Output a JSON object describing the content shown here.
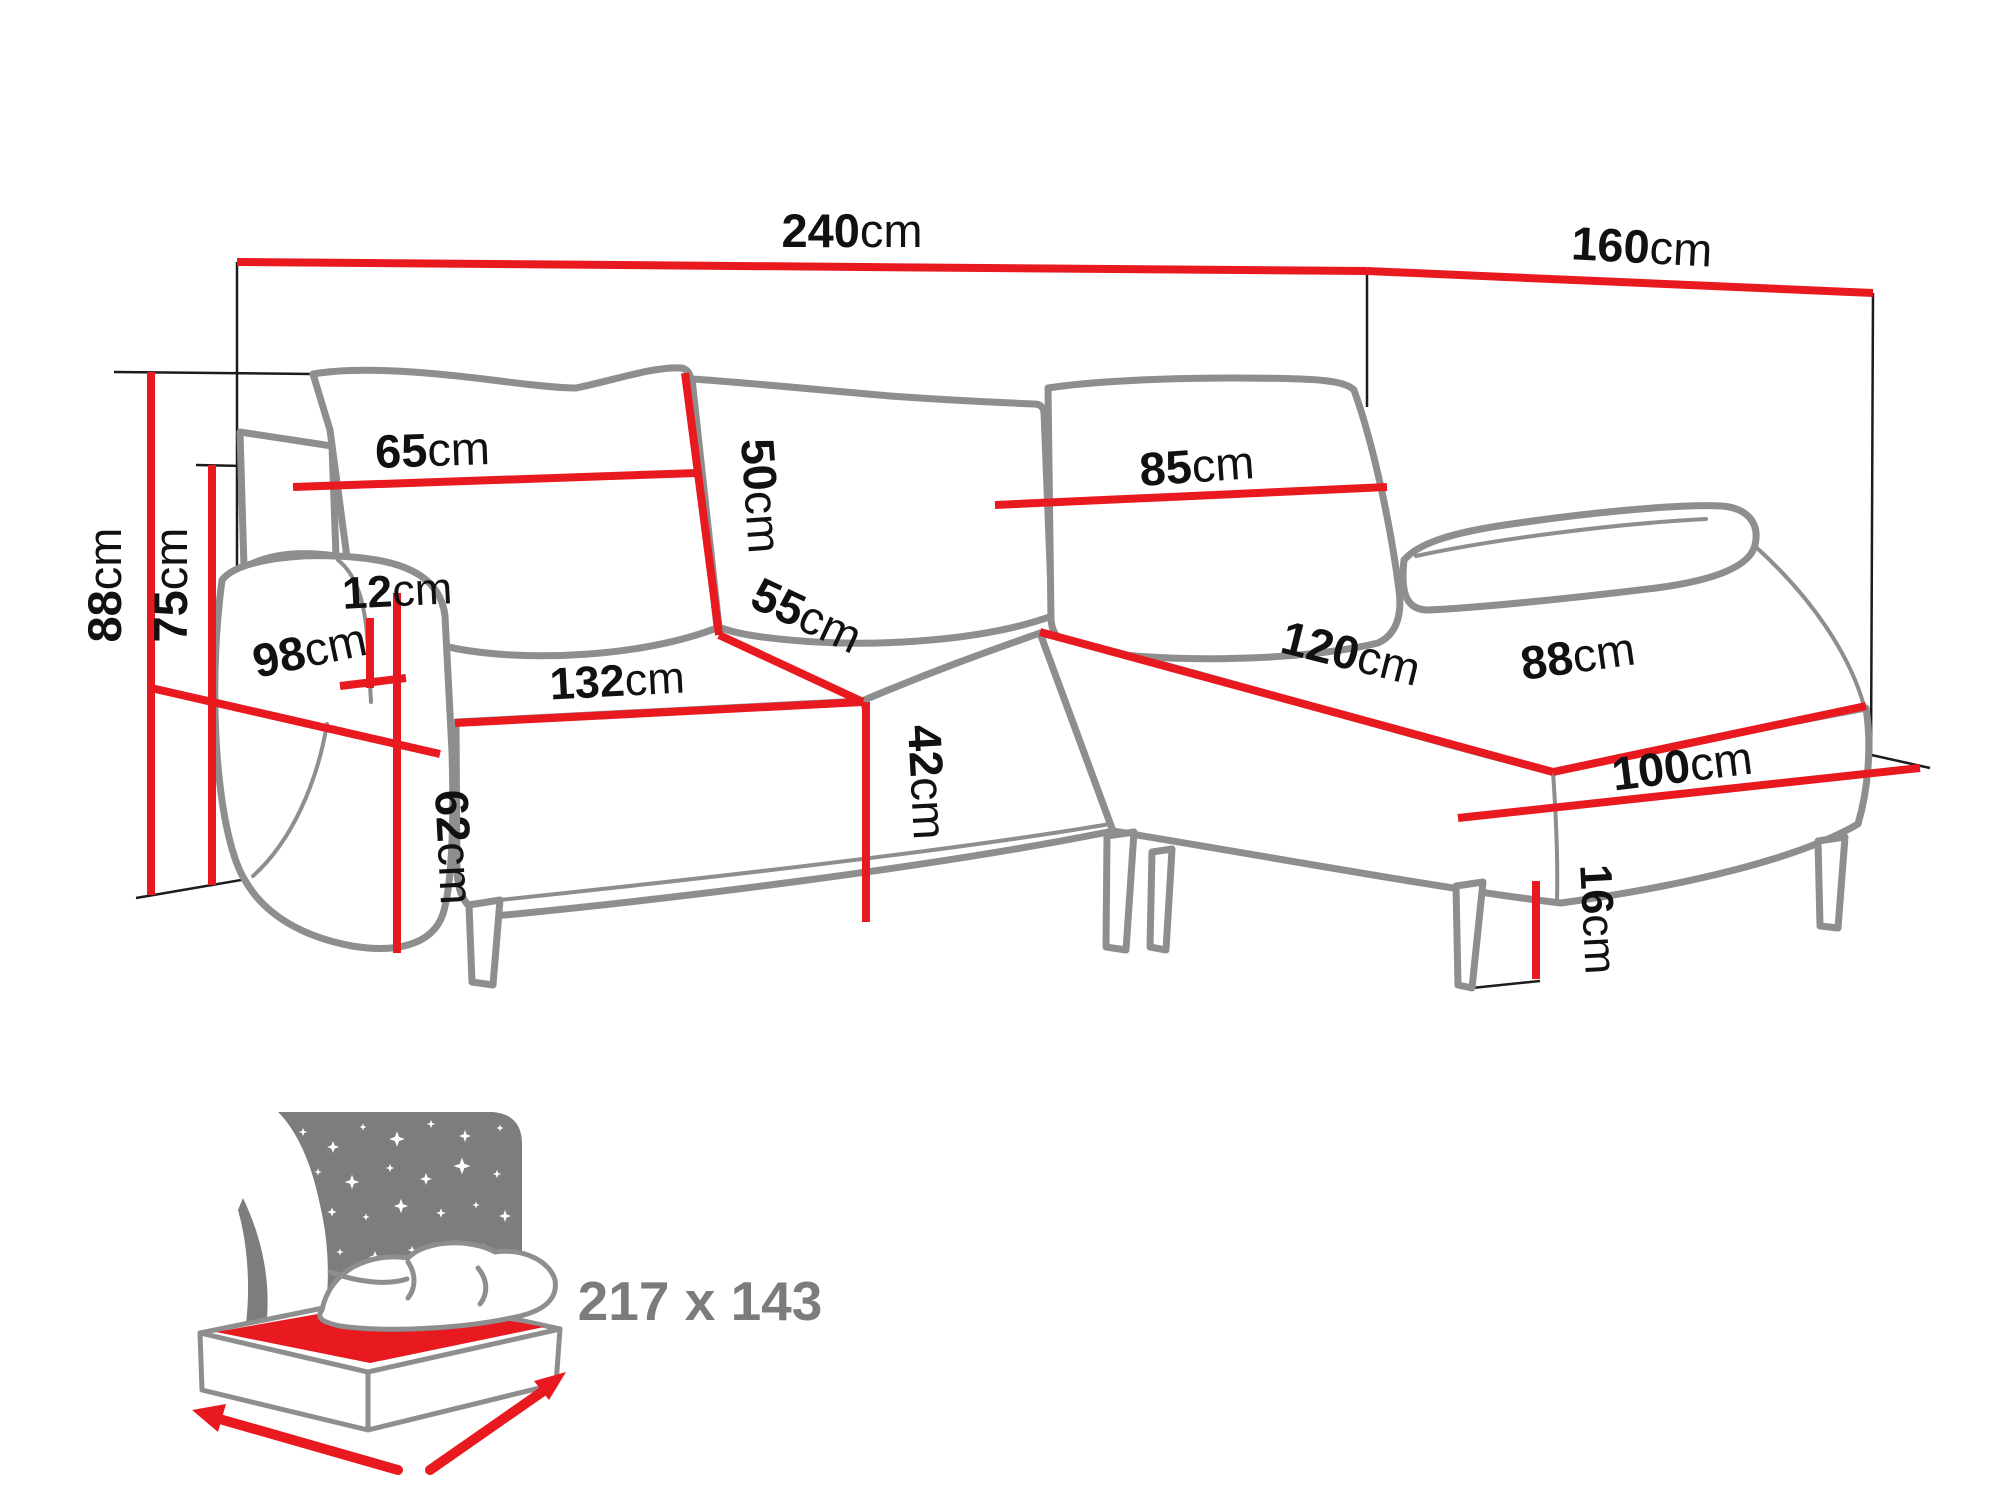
{
  "diagram": {
    "title": "corner-sofa-dimension-diagram",
    "unit_default": "cm",
    "colors": {
      "dimension_line": "#e8191f",
      "sofa_outline": "#8e8e8e",
      "helper_line": "#1c1c1c",
      "label_text": "#111111",
      "icon_gray": "#7d7d7d",
      "icon_text": "#7c7c7c"
    },
    "dims": {
      "total_width": {
        "value": "240",
        "unit": "cm"
      },
      "total_depth": {
        "value": "160",
        "unit": "cm"
      },
      "total_height": {
        "value": "88",
        "unit": "cm"
      },
      "backrest_height": {
        "value": "75",
        "unit": "cm"
      },
      "back_cushion_left": {
        "value": "65",
        "unit": "cm"
      },
      "back_cushion_depth": {
        "value": "50",
        "unit": "cm"
      },
      "back_cushion_right": {
        "value": "85",
        "unit": "cm"
      },
      "armrest_width": {
        "value": "12",
        "unit": "cm"
      },
      "armrest_depth": {
        "value": "98",
        "unit": "cm"
      },
      "armrest_height": {
        "value": "62",
        "unit": "cm"
      },
      "seat_width": {
        "value": "132",
        "unit": "cm"
      },
      "seat_depth": {
        "value": "55",
        "unit": "cm"
      },
      "seat_height": {
        "value": "42",
        "unit": "cm"
      },
      "chaise_length": {
        "value": "120",
        "unit": "cm"
      },
      "chaise_width": {
        "value": "88",
        "unit": "cm"
      },
      "chaise_side_length": {
        "value": "100",
        "unit": "cm"
      },
      "leg_height": {
        "value": "16",
        "unit": "cm"
      }
    },
    "sleeping_area": {
      "label": "217 x 143"
    }
  }
}
